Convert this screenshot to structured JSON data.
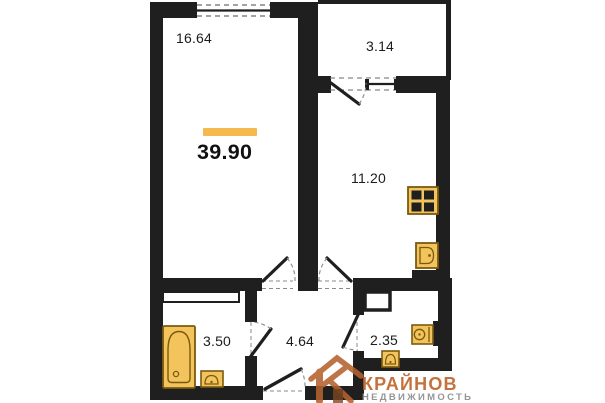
{
  "plan": {
    "total_area": "39.90",
    "rooms": {
      "living": {
        "area": "16.64"
      },
      "balcony": {
        "area": "3.14"
      },
      "kitchen": {
        "area": "11.20"
      },
      "bathroom": {
        "area": "3.50"
      },
      "hallway": {
        "area": "4.64"
      },
      "wc": {
        "area": "2.35"
      }
    },
    "fixtures": [
      "bathtub",
      "bathroom-sink",
      "gas-stove",
      "kitchen-sink",
      "toilet",
      "wc-sink"
    ],
    "colors": {
      "wall": "#1f1f1f",
      "fixture_fill": "#f3c35c",
      "fixture_stroke": "#7a5a10",
      "accent_bar": "#f5b94e"
    }
  },
  "watermark": {
    "brand": "КРАЙНОВ",
    "subtitle": "НЕДВИЖИМОСТЬ",
    "brand_color": "#c1662d",
    "subtitle_color": "#909090"
  }
}
